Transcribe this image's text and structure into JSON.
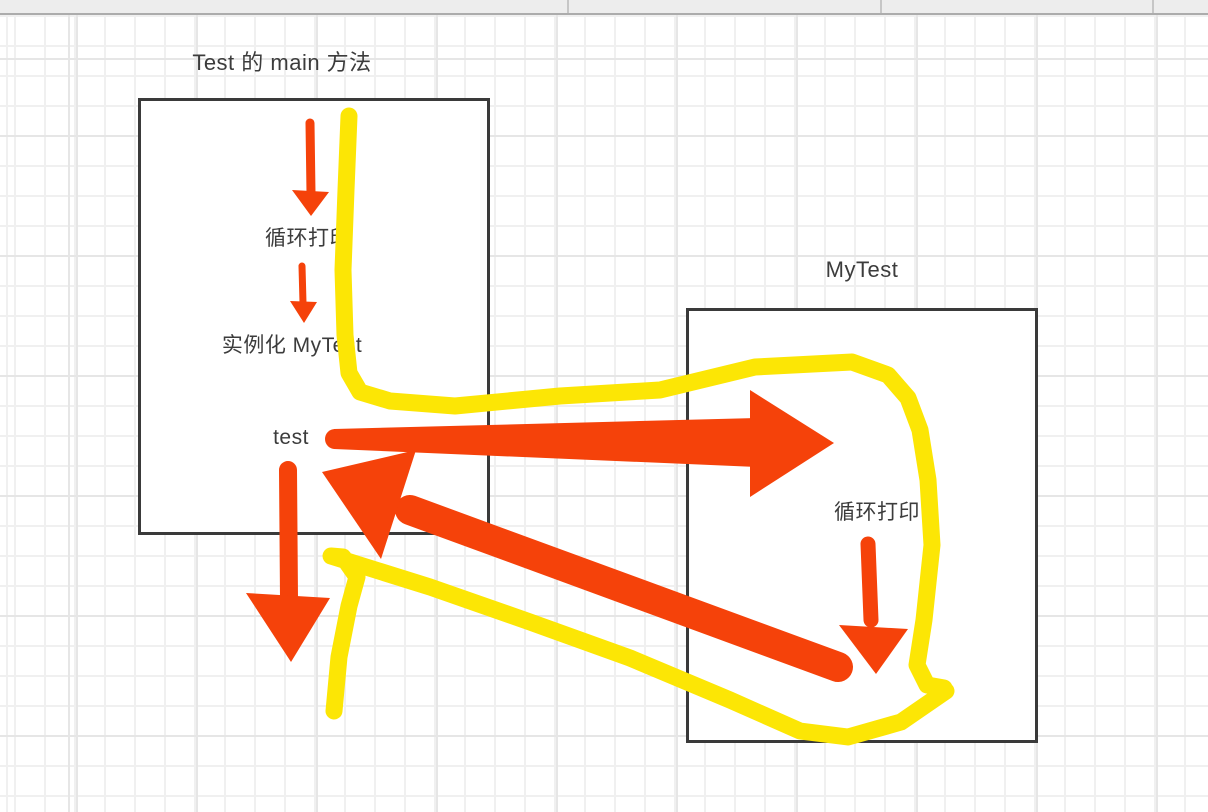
{
  "colors": {
    "arrow_red": "#F5420A",
    "highlight_yellow": "#FCE605",
    "box_border": "#3A3A3A",
    "text": "#3C3C3C",
    "grid_minor": "#F0F0F0",
    "grid_major": "#E6E6E6",
    "topbar_bg": "#EDEDED",
    "topbar_border": "#ACACAC",
    "topbar_divider": "#C6C6C6"
  },
  "diagram": {
    "test_box": {
      "title": "Test 的 main 方法",
      "step_loop_print": "循环打印",
      "step_instantiate": "实例化 MyTest",
      "step_test": "test"
    },
    "mytest_box": {
      "title": "MyTest",
      "step_loop_print": "循环打印"
    }
  }
}
